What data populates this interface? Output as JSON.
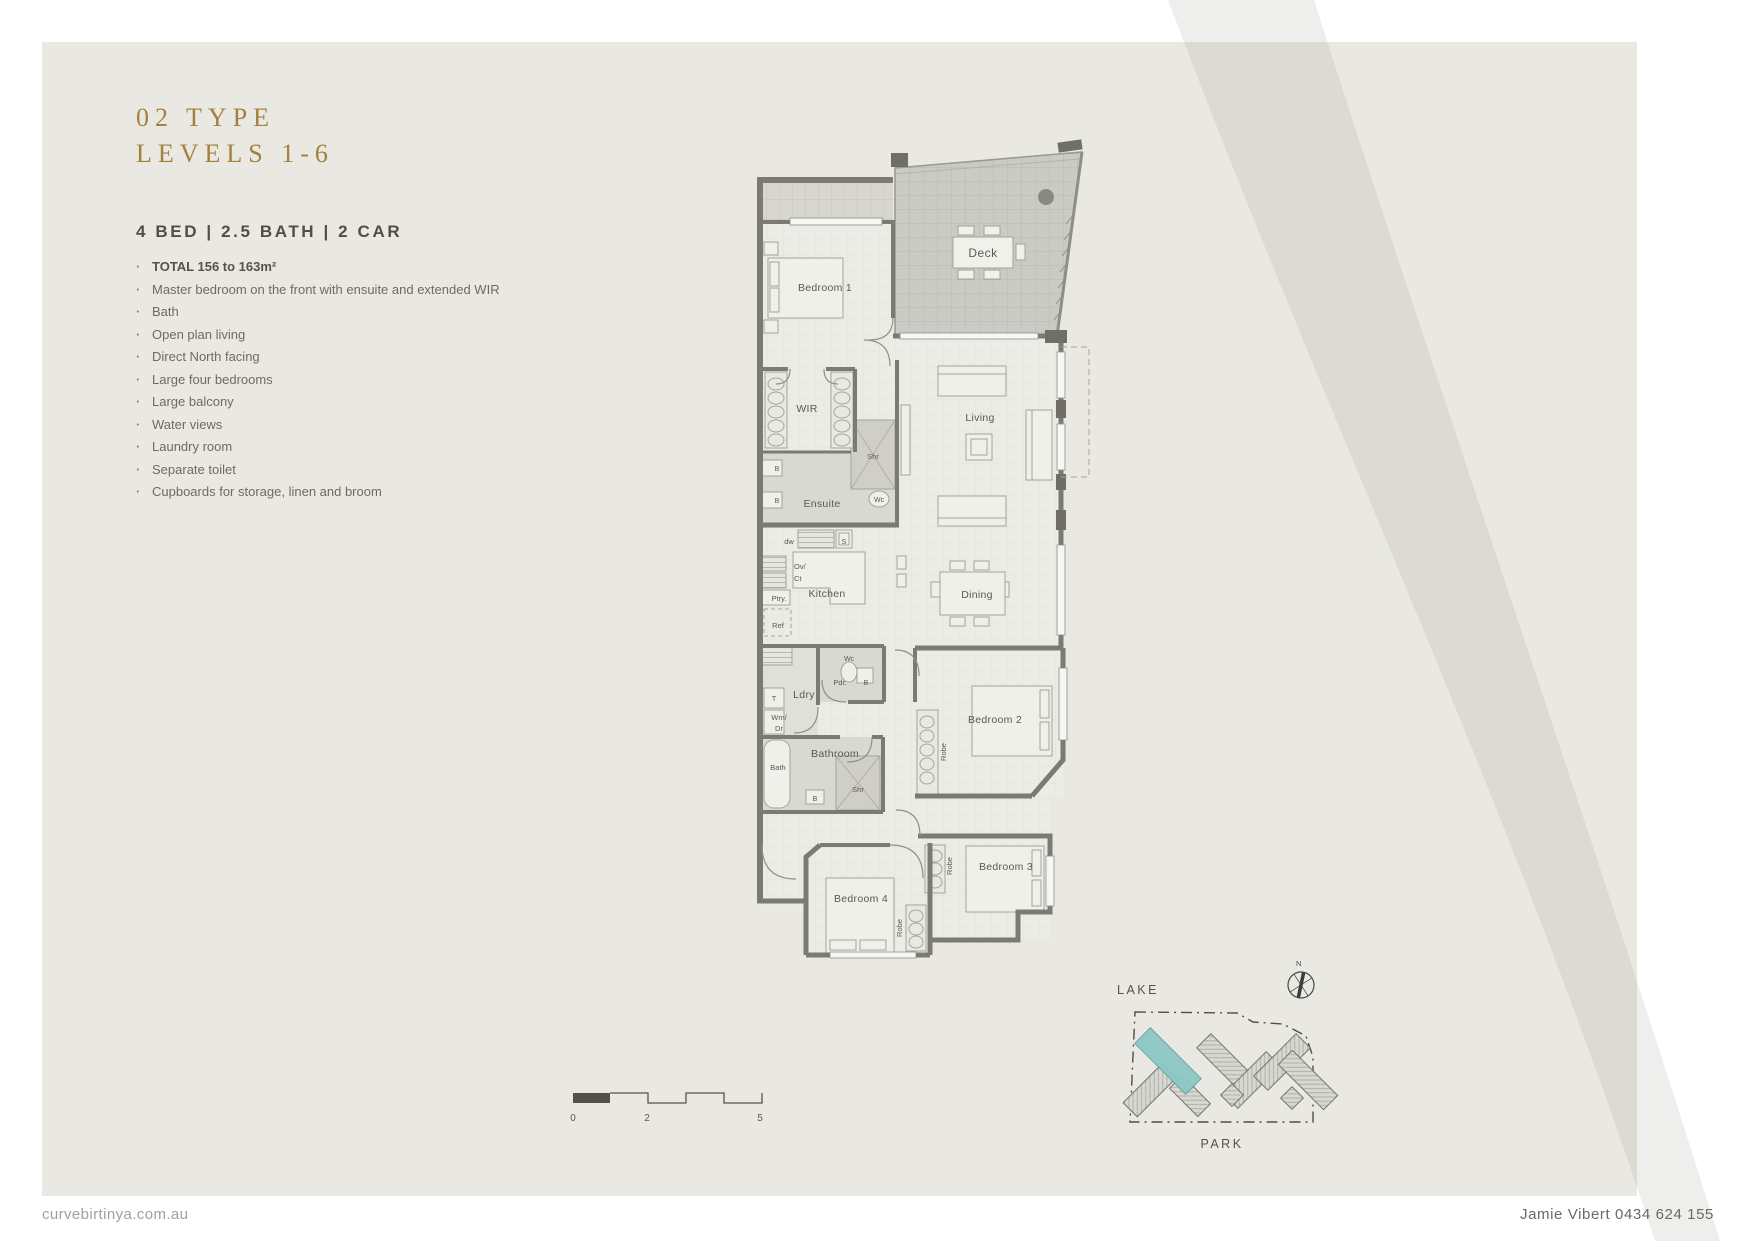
{
  "header": {
    "type_title": "02 TYPE",
    "levels": "LEVELS 1-6",
    "spec": "4 BED | 2.5 BATH | 2 CAR"
  },
  "features": [
    "TOTAL 156 to 163m²",
    "Master bedroom on the front with ensuite and extended WIR",
    "Bath",
    "Open plan living",
    "Direct North facing",
    "Large four bedrooms",
    "Large balcony",
    "Water views",
    "Laundry room",
    "Separate toilet",
    "Cupboards for storage, linen and broom"
  ],
  "plan": {
    "rooms": {
      "deck": "Deck",
      "bedroom1": "Bedroom 1",
      "wir": "WIR",
      "ensuite": "Ensuite",
      "living": "Living",
      "kitchen": "Kitchen",
      "dining": "Dining",
      "ldry": "Ldry",
      "pdr": "Pdr.",
      "bathroom": "Bathroom",
      "bedroom2": "Bedroom 2",
      "bedroom3": "Bedroom 3",
      "bedroom4": "Bedroom 4"
    },
    "fixtures": {
      "shr": "Shr",
      "wc": "Wc",
      "basin": "B",
      "dw": "dw",
      "sink": "S",
      "ov": "Ov/",
      "ct": "Ct",
      "ptry": "Ptry.",
      "ref": "Ref",
      "t": "T",
      "wm": "Wm/",
      "dr": "Dr",
      "bath": "Bath",
      "robe": "Robe"
    }
  },
  "sitemap": {
    "lake": "LAKE",
    "park": "PARK",
    "north": "N"
  },
  "scalebar": {
    "labels": [
      "0",
      "2",
      "5"
    ]
  },
  "footer": {
    "website": "curvebirtinya.com.au",
    "agent": "Jamie Vibert 0434 624 155"
  },
  "colors": {
    "accent_gold": "#a5813e",
    "card_bg": "#e9e8e2",
    "wall": "#7b7a73",
    "highlight_teal": "#8ec7c4"
  }
}
